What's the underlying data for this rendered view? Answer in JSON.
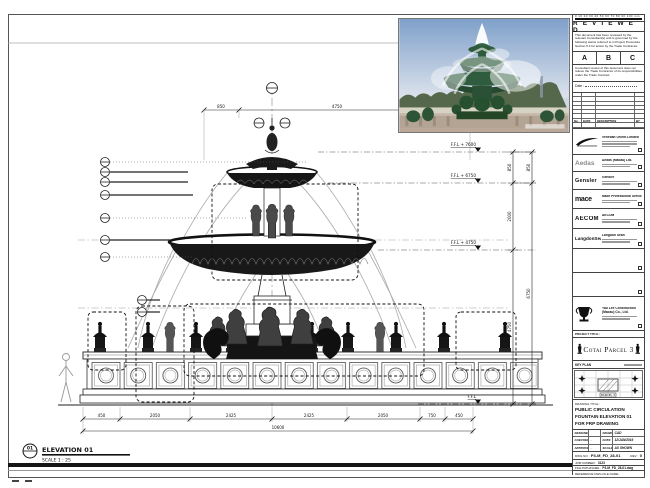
{
  "sheet": {
    "elevation_label": "ELEVATION 01",
    "elevation_scale": "SCALE  1 : 25",
    "detail_no": "01",
    "scale_bar_numbers": "0 10 20 30 40 50 60 70 80 90 100 mm"
  },
  "drawing": {
    "levels": [
      {
        "label": "F.F.L + 7600"
      },
      {
        "label": "F.F.L + 6750"
      },
      {
        "label": "F.F.L + 4750"
      },
      {
        "label": "F.F.L"
      }
    ],
    "dims": {
      "top_chain": [
        "850",
        "4750",
        "850"
      ],
      "right_chain": [
        "850",
        "2000",
        "4750"
      ],
      "right_overall": [
        "850",
        "6750"
      ],
      "bottom_chain": [
        "450",
        "2050",
        "2425",
        "2425",
        "2050",
        "750",
        "450"
      ],
      "bottom_overall": "10600"
    }
  },
  "stamp": {
    "title": "R E V I E W E D",
    "para1": "This document has been reviewed by the relevant Consultant(s) and is governed by the following status referred to in Project Procedure Section 5.4 for action by the Trade Contractor.",
    "statuses": [
      "A",
      "B",
      "C"
    ],
    "para2": "Consultant review of this document does not relieve the Trade Contractor of its responsibilities under the Trade Contract.",
    "date_label": "Date :"
  },
  "revision_table": {
    "headers": [
      "No.",
      "DATE",
      "DESCRIPTION",
      "BY"
    ]
  },
  "companies": [
    {
      "name": "Venetian Orient Limited",
      "logo": "venetian-swoosh"
    },
    {
      "name": "Aedas (Macau) Ltd.",
      "logo_text": "Aedas"
    },
    {
      "name": "Gensler",
      "logo_text": "Gensler"
    },
    {
      "name": "Mace Professional Services Ltd.",
      "logo_text": "mace"
    },
    {
      "name": "AECOM",
      "logo_text": "AECOM"
    },
    {
      "name": "Langdon Seah",
      "logo_text": "LangdonSeah"
    }
  ],
  "contractor": {
    "name": "Yau Lee Construction (Macau) Co., Ltd."
  },
  "project": {
    "title_label": "PROJECT TITLE :",
    "title": "Cotai Parcel 3"
  },
  "key_plan": {
    "label": "KEY PLAN",
    "sublabel": "PARCEL 3"
  },
  "title_box": {
    "label": "DRAWING TITLE :",
    "lines": [
      "PUBLIC CIRCULATION",
      "FOUNTAIN ELEVATION 01",
      "FOR FRP DRAWING"
    ]
  },
  "credits": {
    "rows": [
      {
        "k1": "DESIGNED",
        "v1": "",
        "k2": "DRAWN",
        "v2": "CAD"
      },
      {
        "k1": "CHECKED",
        "v1": "-",
        "k2": "DATE",
        "v2": "12/JAN/2016"
      },
      {
        "k1": "APPROVED",
        "v1": "-",
        "k2": "SCALE",
        "v2": "AS SHOWN"
      }
    ],
    "dwg_no_label": "DWG NO :",
    "dwg_no": "P3-M_FD_28-01",
    "rev_label": "REV :",
    "rev": "0",
    "job_label": "JOB NUMBER :",
    "job": "3123",
    "file_label": "FILE PATH/NAME :",
    "file": "P3-M_FD_28-01.dwg",
    "ref_label": "REFERENCE DWG FILE NAME :"
  }
}
